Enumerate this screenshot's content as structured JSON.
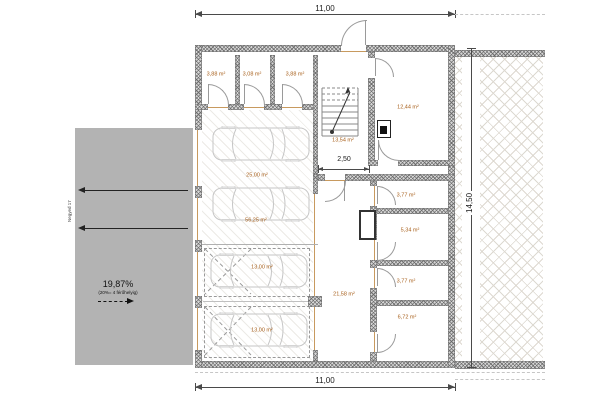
{
  "plan": {
    "dims": {
      "width_top": "11,00",
      "width_bottom": "11,00",
      "height_right": "14,50",
      "stair_hall_width": "2,50"
    },
    "ramp": {
      "slope": "19,87%",
      "note": "(20%= 4 férőhelyig)",
      "street": "Negyed 17"
    },
    "rooms": {
      "storage_1": "3,88 m²",
      "storage_2": "3,08 m²",
      "storage_3": "3,88 m²",
      "stair_hall": "13,54 m²",
      "room_top_right": "12,44 m²",
      "garage_front": "25,00 m²",
      "garage_main": "56,25 m²",
      "parking_1": "13,00 m²",
      "parking_2": "13,00 m²",
      "corridor": "21,58 m²",
      "store_a": "3,77 m²",
      "store_b": "5,34 m²",
      "store_c": "3,77 m²",
      "store_d": "6,72 m²"
    },
    "colors": {
      "room_label": "#a8601c",
      "lintel": "#c89a5f",
      "ramp_fill": "#b3b3b3",
      "wall_edge": "#777777"
    }
  }
}
